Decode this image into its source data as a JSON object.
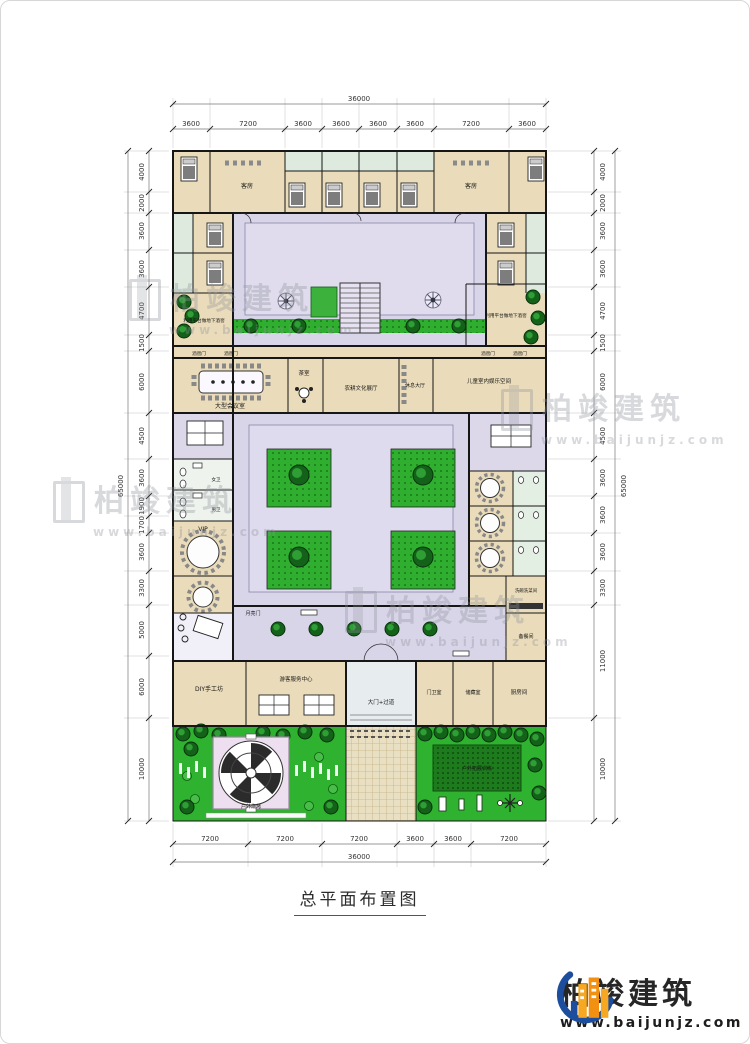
{
  "page": {
    "title": "总平面布置图"
  },
  "brand": {
    "name": "柏竣建筑",
    "url": "www.baijunjz.com"
  },
  "watermark": {
    "name": "柏竣建筑",
    "url": "www.baijunjz.com"
  },
  "dims": {
    "top": {
      "total": "36000",
      "segs": [
        "3600",
        "7200",
        "3600",
        "3600",
        "3600",
        "3600",
        "7200",
        "3600"
      ]
    },
    "bottom": {
      "total": "36000",
      "segs": [
        "7200",
        "7200",
        "7200",
        "3600",
        "3600",
        "7200"
      ]
    },
    "left": {
      "total": "65000",
      "segs": [
        "4000",
        "2000",
        "3600",
        "3600",
        "4700",
        "1500",
        "6000",
        "4500",
        "3600",
        "1900",
        "1700",
        "3600",
        "3300",
        "5000",
        "6000",
        "10000"
      ]
    },
    "right": {
      "total": "65000",
      "segs": [
        "4000",
        "2000",
        "3600",
        "3600",
        "4700",
        "1500",
        "6000",
        "4500",
        "3600",
        "3600",
        "3600",
        "3300",
        "11000",
        "10000"
      ]
    }
  },
  "rooms": {
    "guest_room": "客房",
    "platform_cellar": "利用平台做地下酒窖",
    "cellar_door": "酒窖门",
    "large_conference": "大型会议室",
    "tea_room": "茶室",
    "culture_hall": "农耕文化展厅",
    "rest_hall": "休息大厅",
    "kids_space": "儿童室内娱乐空间",
    "vip": "VIP",
    "female_wc": "女卫",
    "male_wc": "男卫",
    "moon_gate": "月亮门",
    "diy_workshop": "DIY手工坊",
    "visitor_center": "游客服务中心",
    "main_gate": "大门+过道",
    "guard_room": "门卫室",
    "storage": "储藏室",
    "kitchen": "厨房间",
    "prep_room": "备餐间",
    "wash_room": "洗碗洗菜间",
    "outdoor_bbq": "户外烧烤",
    "outdoor_training": "户外拓展训练"
  },
  "colors": {
    "room_fill": "#eadcba",
    "courtyard": "#d9d5e9",
    "bath": "#ddeadd",
    "lawn": "#2fb22f",
    "training_lawn": "#1d7a1d",
    "pavement": "#e9dfc2",
    "wall": "#161616",
    "logo_orange": "#f5a31d",
    "logo_blue": "#1d4e9e",
    "watermark": "#8e939b"
  }
}
